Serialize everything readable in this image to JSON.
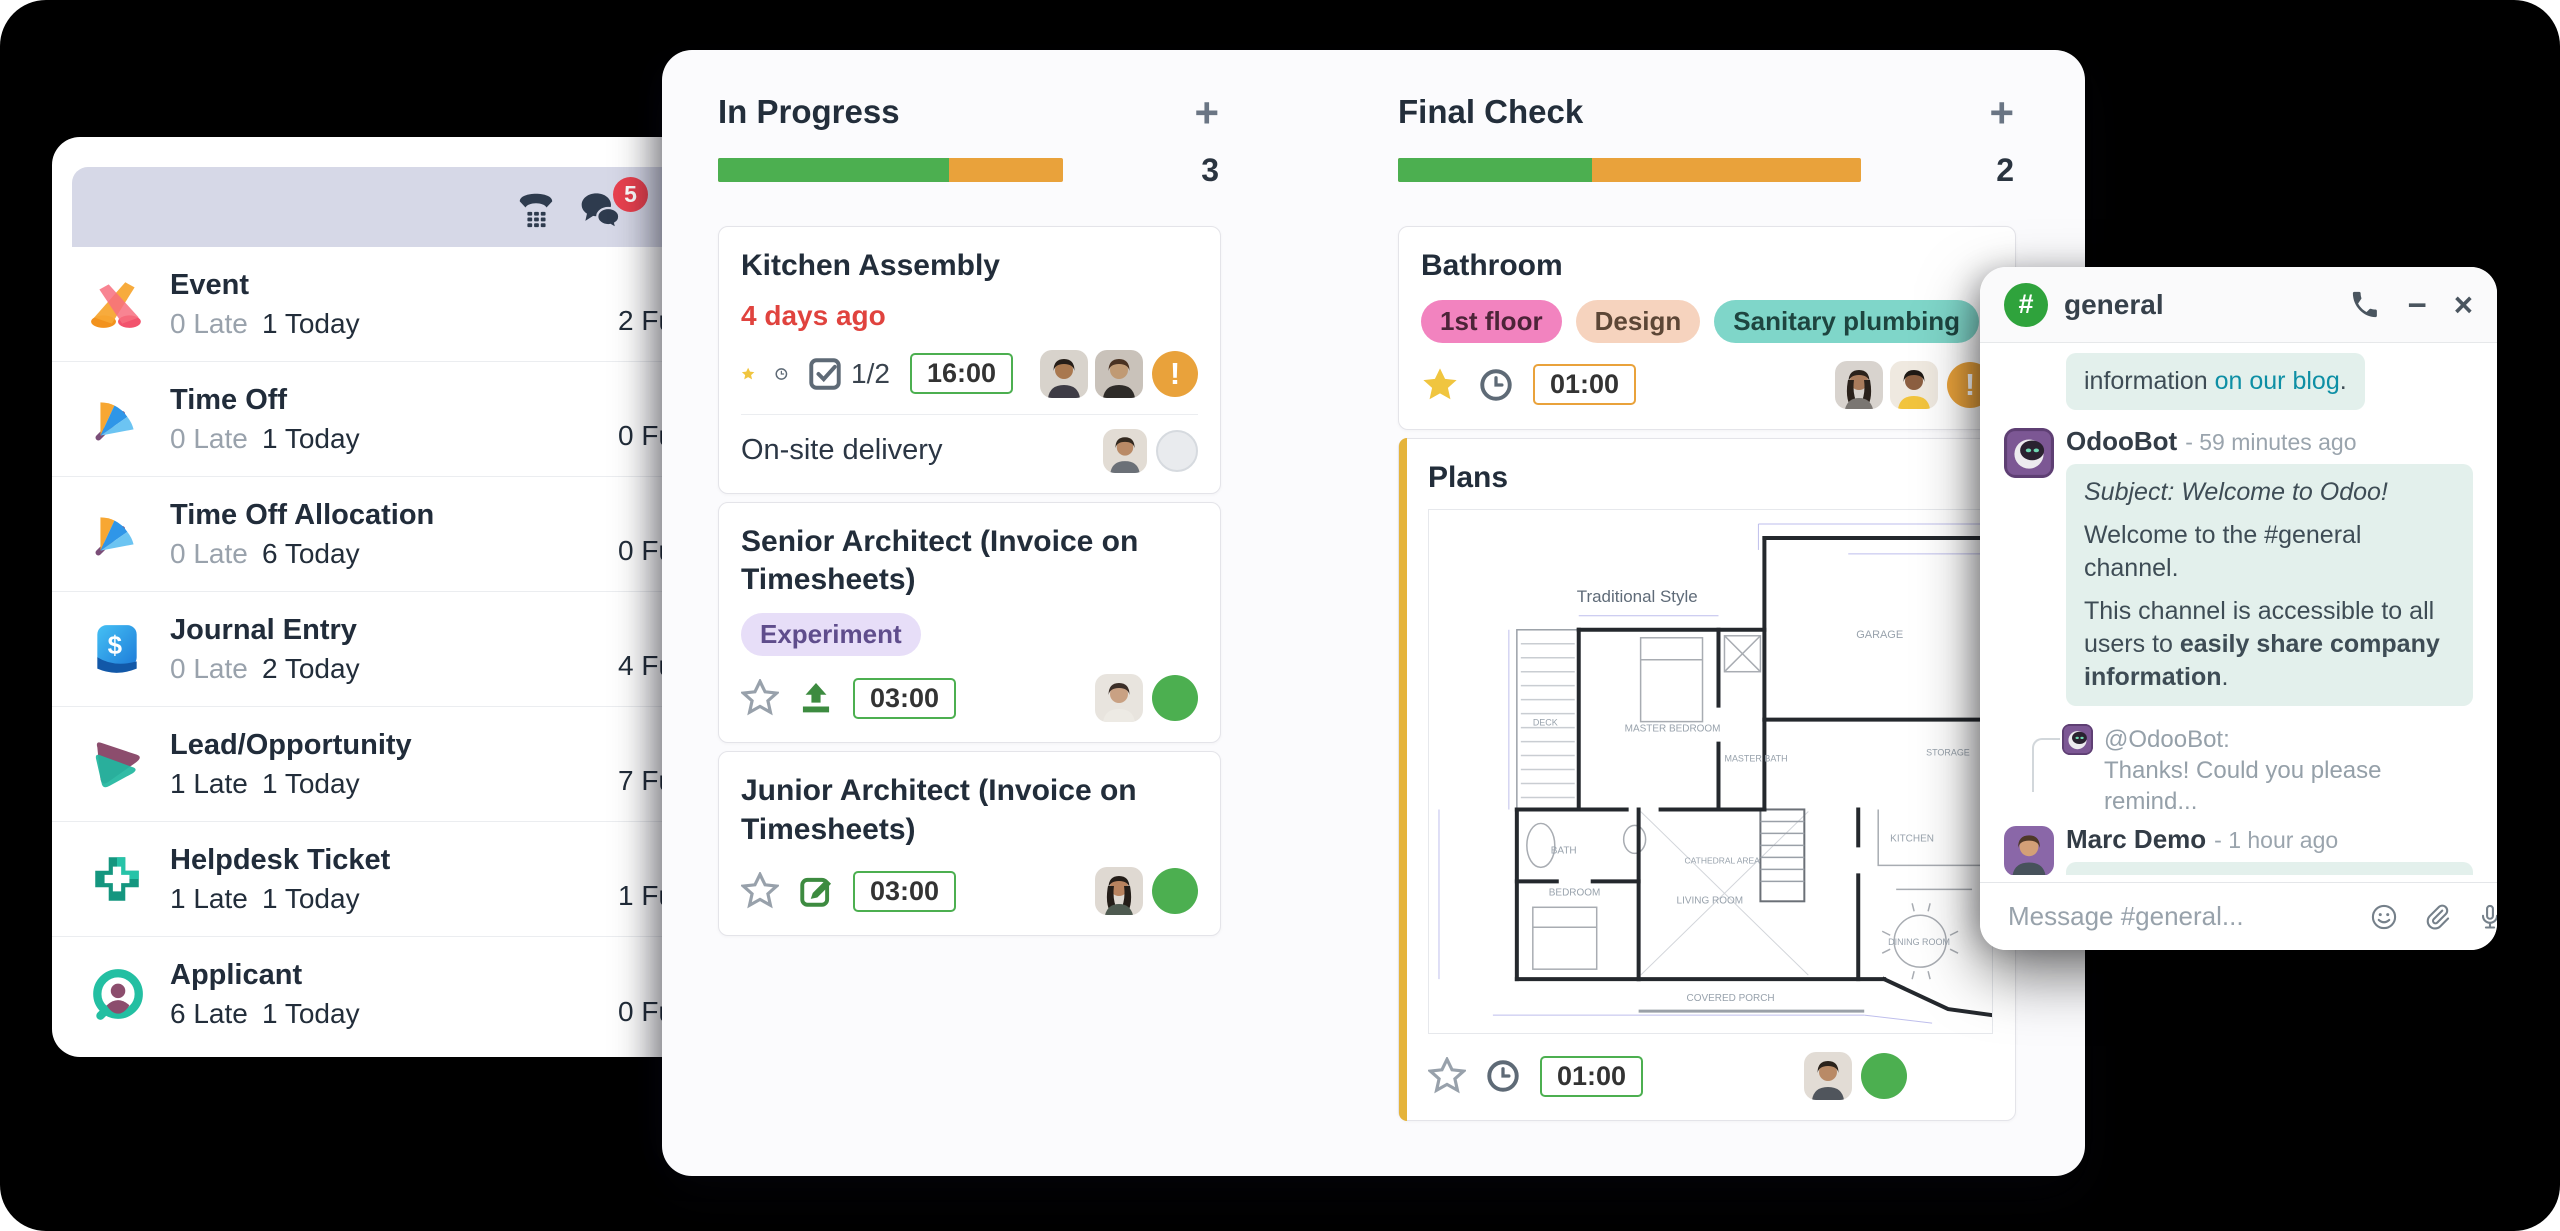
{
  "icons": {
    "plus": "+",
    "exclamation": "!",
    "dollar": "$"
  },
  "left_panel": {
    "header": {
      "chat_badge": "5"
    },
    "items": [
      {
        "label": "Event",
        "late": "0 Late",
        "today": "1 Today",
        "future": "2 Fu"
      },
      {
        "label": "Time Off",
        "late": "0 Late",
        "today": "1 Today",
        "future": "0 Fu"
      },
      {
        "label": "Time Off Allocation",
        "late": "0 Late",
        "today": "6 Today",
        "future": "0 Fu"
      },
      {
        "label": "Journal Entry",
        "late": "0 Late",
        "today": "2 Today",
        "future": "4 Fu"
      },
      {
        "label": "Lead/Opportunity",
        "late": "1 Late",
        "today": "1 Today",
        "future": "7 Fu"
      },
      {
        "label": "Helpdesk Ticket",
        "late": "1 Late",
        "today": "1 Today",
        "future": "1 Fu"
      },
      {
        "label": "Applicant",
        "late": "6 Late",
        "today": "1 Today",
        "future": "0 Fu"
      }
    ]
  },
  "kanban": {
    "columns": [
      {
        "title": "In Progress",
        "count": "3",
        "progress_green": "67%"
      },
      {
        "title": "Final Check",
        "count": "2",
        "progress_green": "42%"
      }
    ],
    "cards": {
      "kitchen": {
        "title": "Kitchen Assembly",
        "overdue": "4 days ago",
        "checklist": "1/2",
        "time": "16:00",
        "subtask": "On-site delivery"
      },
      "senior": {
        "title": "Senior Architect (Invoice on Timesheets)",
        "tag": "Experiment",
        "time": "03:00"
      },
      "junior": {
        "title": "Junior Architect (Invoice on Timesheets)",
        "time": "03:00"
      },
      "bathroom": {
        "title": "Bathroom",
        "tags": [
          "1st floor",
          "Design",
          "Sanitary plumbing"
        ],
        "time": "01:00"
      },
      "plans": {
        "title": "Plans",
        "time": "01:00",
        "floorplan": {
          "style": "Traditional Style",
          "rooms": [
            "DECK",
            "MASTER BEDROOM",
            "MASTER BATH",
            "GARAGE",
            "BATH",
            "BEDROOM",
            "LIVING ROOM",
            "CATHEDRAL AREA",
            "STORAGE",
            "KITCHEN",
            "DINING ROOM",
            "COVERED PORCH"
          ]
        }
      }
    }
  },
  "chat": {
    "hash": "#",
    "channel": "general",
    "controls": {
      "minimize": "−",
      "close": "×"
    },
    "partial_message": {
      "prefix": "information ",
      "link": "on our blog",
      "suffix": "."
    },
    "odoobot": {
      "author": "OdooBot",
      "time": "- 59 minutes ago",
      "subject": "Subject: Welcome to Odoo!",
      "line1": "Welcome to the #general channel.",
      "line2_prefix": "This channel is accessible to all users to ",
      "line2_bold": "easily share company information",
      "line2_suffix": "."
    },
    "reply": {
      "author": "@OdooBot:",
      "preview": "Thanks! Could you please remind..."
    },
    "marc": {
      "author": "Marc Demo",
      "time": "- 1 hour ago",
      "body": "Building B3, second floor to the right :-)."
    },
    "composer": {
      "placeholder": "Message #general..."
    }
  }
}
